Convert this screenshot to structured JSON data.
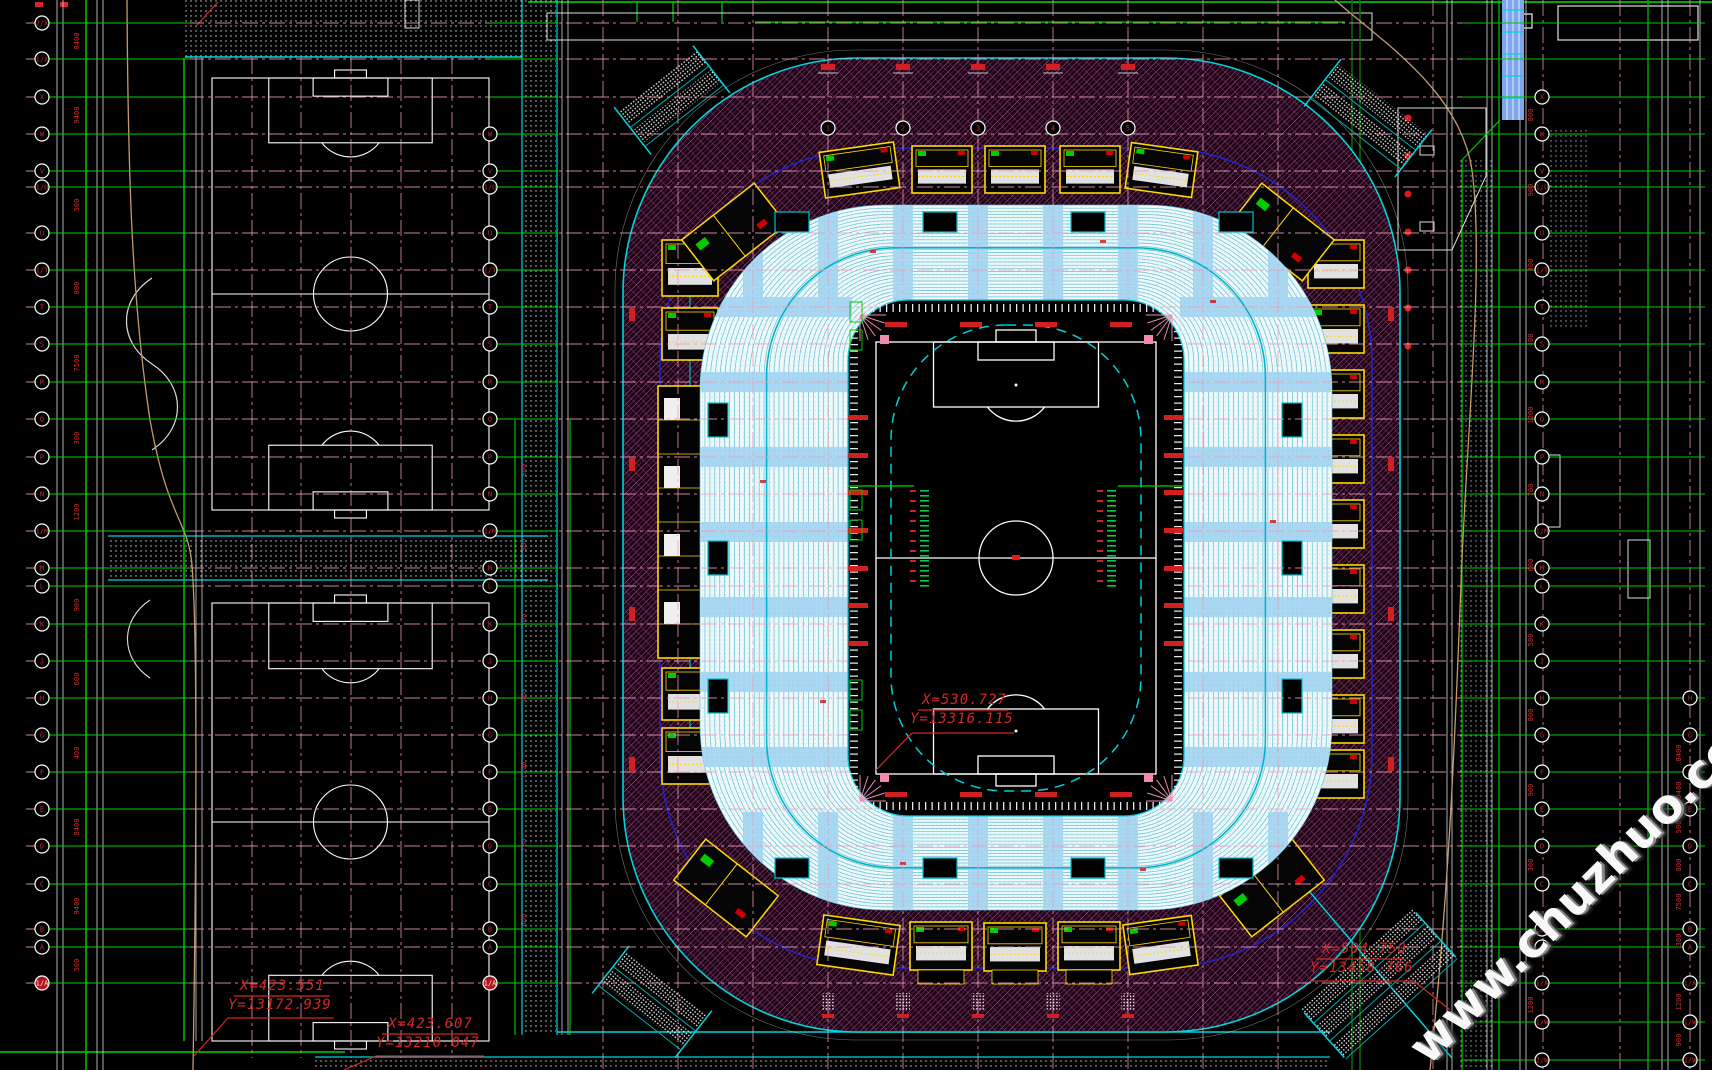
{
  "watermark": {
    "text": "www.chuzhuo.com"
  },
  "coord_labels": [
    {
      "id": "field-center",
      "x_text": "X=530.727",
      "y_text": "Y=13316.115"
    },
    {
      "id": "southwest",
      "x_text": "X=423.551",
      "y_text": "Y=13172.939"
    },
    {
      "id": "south",
      "x_text": "X=423.607",
      "y_text": "Y=13210.047"
    },
    {
      "id": "southeast",
      "x_text": "X=504.750",
      "y_text": "Y=13458.766"
    }
  ],
  "grid_rows": [
    {
      "y": 23,
      "label": "2/X"
    },
    {
      "y": 59,
      "label": "1/X"
    },
    {
      "y": 97,
      "label": "X"
    },
    {
      "y": 134,
      "label": "W"
    },
    {
      "y": 171,
      "label": "V"
    },
    {
      "y": 187,
      "label": "1/U"
    },
    {
      "y": 233,
      "label": "U"
    },
    {
      "y": 270,
      "label": "1/T"
    },
    {
      "y": 307,
      "label": "T"
    },
    {
      "y": 344,
      "label": "S"
    },
    {
      "y": 382,
      "label": "R"
    },
    {
      "y": 419,
      "label": "Q"
    },
    {
      "y": 457,
      "label": "P"
    },
    {
      "y": 494,
      "label": "N"
    },
    {
      "y": 531,
      "label": "1/M"
    },
    {
      "y": 568,
      "label": "M"
    },
    {
      "y": 586,
      "label": "L"
    },
    {
      "y": 624,
      "label": "K"
    },
    {
      "y": 661,
      "label": "J"
    },
    {
      "y": 698,
      "label": "H"
    },
    {
      "y": 735,
      "label": "G"
    },
    {
      "y": 772,
      "label": "F"
    },
    {
      "y": 809,
      "label": "E"
    },
    {
      "y": 846,
      "label": "D"
    },
    {
      "y": 884,
      "label": "C"
    },
    {
      "y": 929,
      "label": "B"
    },
    {
      "y": 947,
      "label": "A"
    },
    {
      "y": 983,
      "label": "1/A"
    }
  ],
  "grid_rows_extra_right": [
    {
      "y": 1022,
      "label": "1/W"
    },
    {
      "y": 1060,
      "label": "2/W"
    }
  ],
  "grid_cols_top": [
    {
      "x": 828,
      "label": "1"
    },
    {
      "x": 903,
      "label": "2"
    },
    {
      "x": 978,
      "label": "3"
    },
    {
      "x": 1053,
      "label": "4"
    },
    {
      "x": 1128,
      "label": "5"
    }
  ],
  "dim_values_left": [
    "8400",
    "9400",
    "500",
    "800",
    "7500",
    "300",
    "1200",
    "900",
    "600",
    "400"
  ],
  "dim_values_right": [
    "800",
    "900",
    "300",
    "400",
    "1200",
    "700",
    "600",
    "500"
  ],
  "colors": {
    "pink_grid": "#ef9db6",
    "red": "#d42626",
    "bright_red": "#e01818",
    "green": "#00d400",
    "dark_green": "#0a6e0a",
    "cyan": "#00d4dc",
    "navy": "#2323cc",
    "yellow": "#ffd900",
    "white": "#ffffff",
    "gray": "#d8d8d8",
    "tan": "#c49a6c",
    "blue_band": "#7fa6ea",
    "sky_blue": "#a5d6f2",
    "bowl_row": "#55b8cc",
    "bowl_bg": "#eef9fc",
    "plaza_base": "#1f0019",
    "plaza_hatch": "#a85f86",
    "seat_dot": "#7fb2c4",
    "field_tick_green": "#00cc44",
    "fan_pink": "#f08ab0"
  }
}
